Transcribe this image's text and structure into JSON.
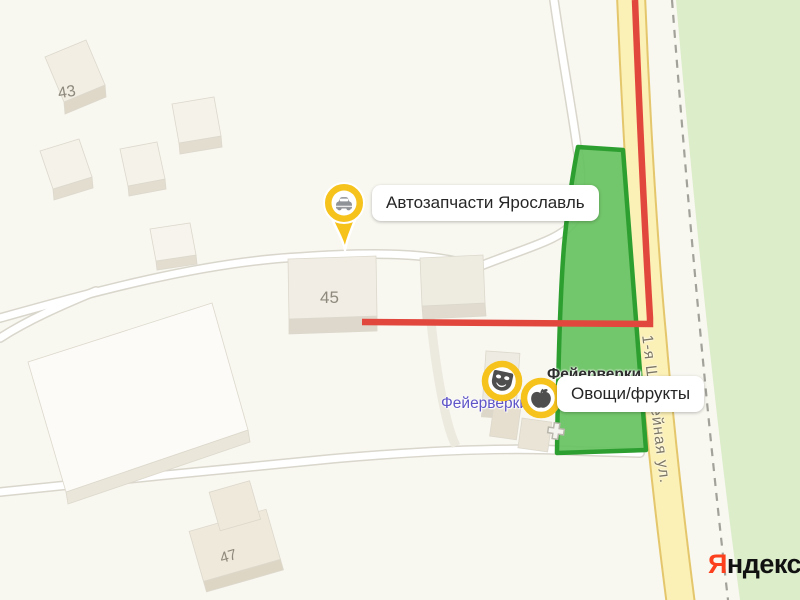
{
  "branding": {
    "logo_first": "Я",
    "logo_rest": "ндекс"
  },
  "street": {
    "name": "1-я Шоссейная ул."
  },
  "buildings": {
    "b43": "43",
    "b45": "45",
    "b47": "47"
  },
  "pois": {
    "auto_parts": {
      "label": "Автозапчасти Ярославль",
      "icon": "car-icon",
      "marker": "yellow-pin"
    },
    "fireworks_badge": {
      "label": "Фейерверки",
      "icon": "mask-icon",
      "marker": "yellow-circle"
    },
    "fireworks_map_text": {
      "label": "Фейерверки"
    },
    "produce": {
      "label": "Овощи/фрукты",
      "icon": "apple-icon",
      "marker": "yellow-circle"
    },
    "entrance": {
      "icon": "plus-icon"
    }
  },
  "colors": {
    "route": "#e2473d",
    "selection_fill": "#66c160",
    "selection_border": "#2d9f31",
    "marker_ring": "#f6c21c",
    "park": "#dcedca",
    "road_fill": "#fbf0b6",
    "road_casing": "#e4c76c",
    "logo_red": "#fc3f1d"
  }
}
